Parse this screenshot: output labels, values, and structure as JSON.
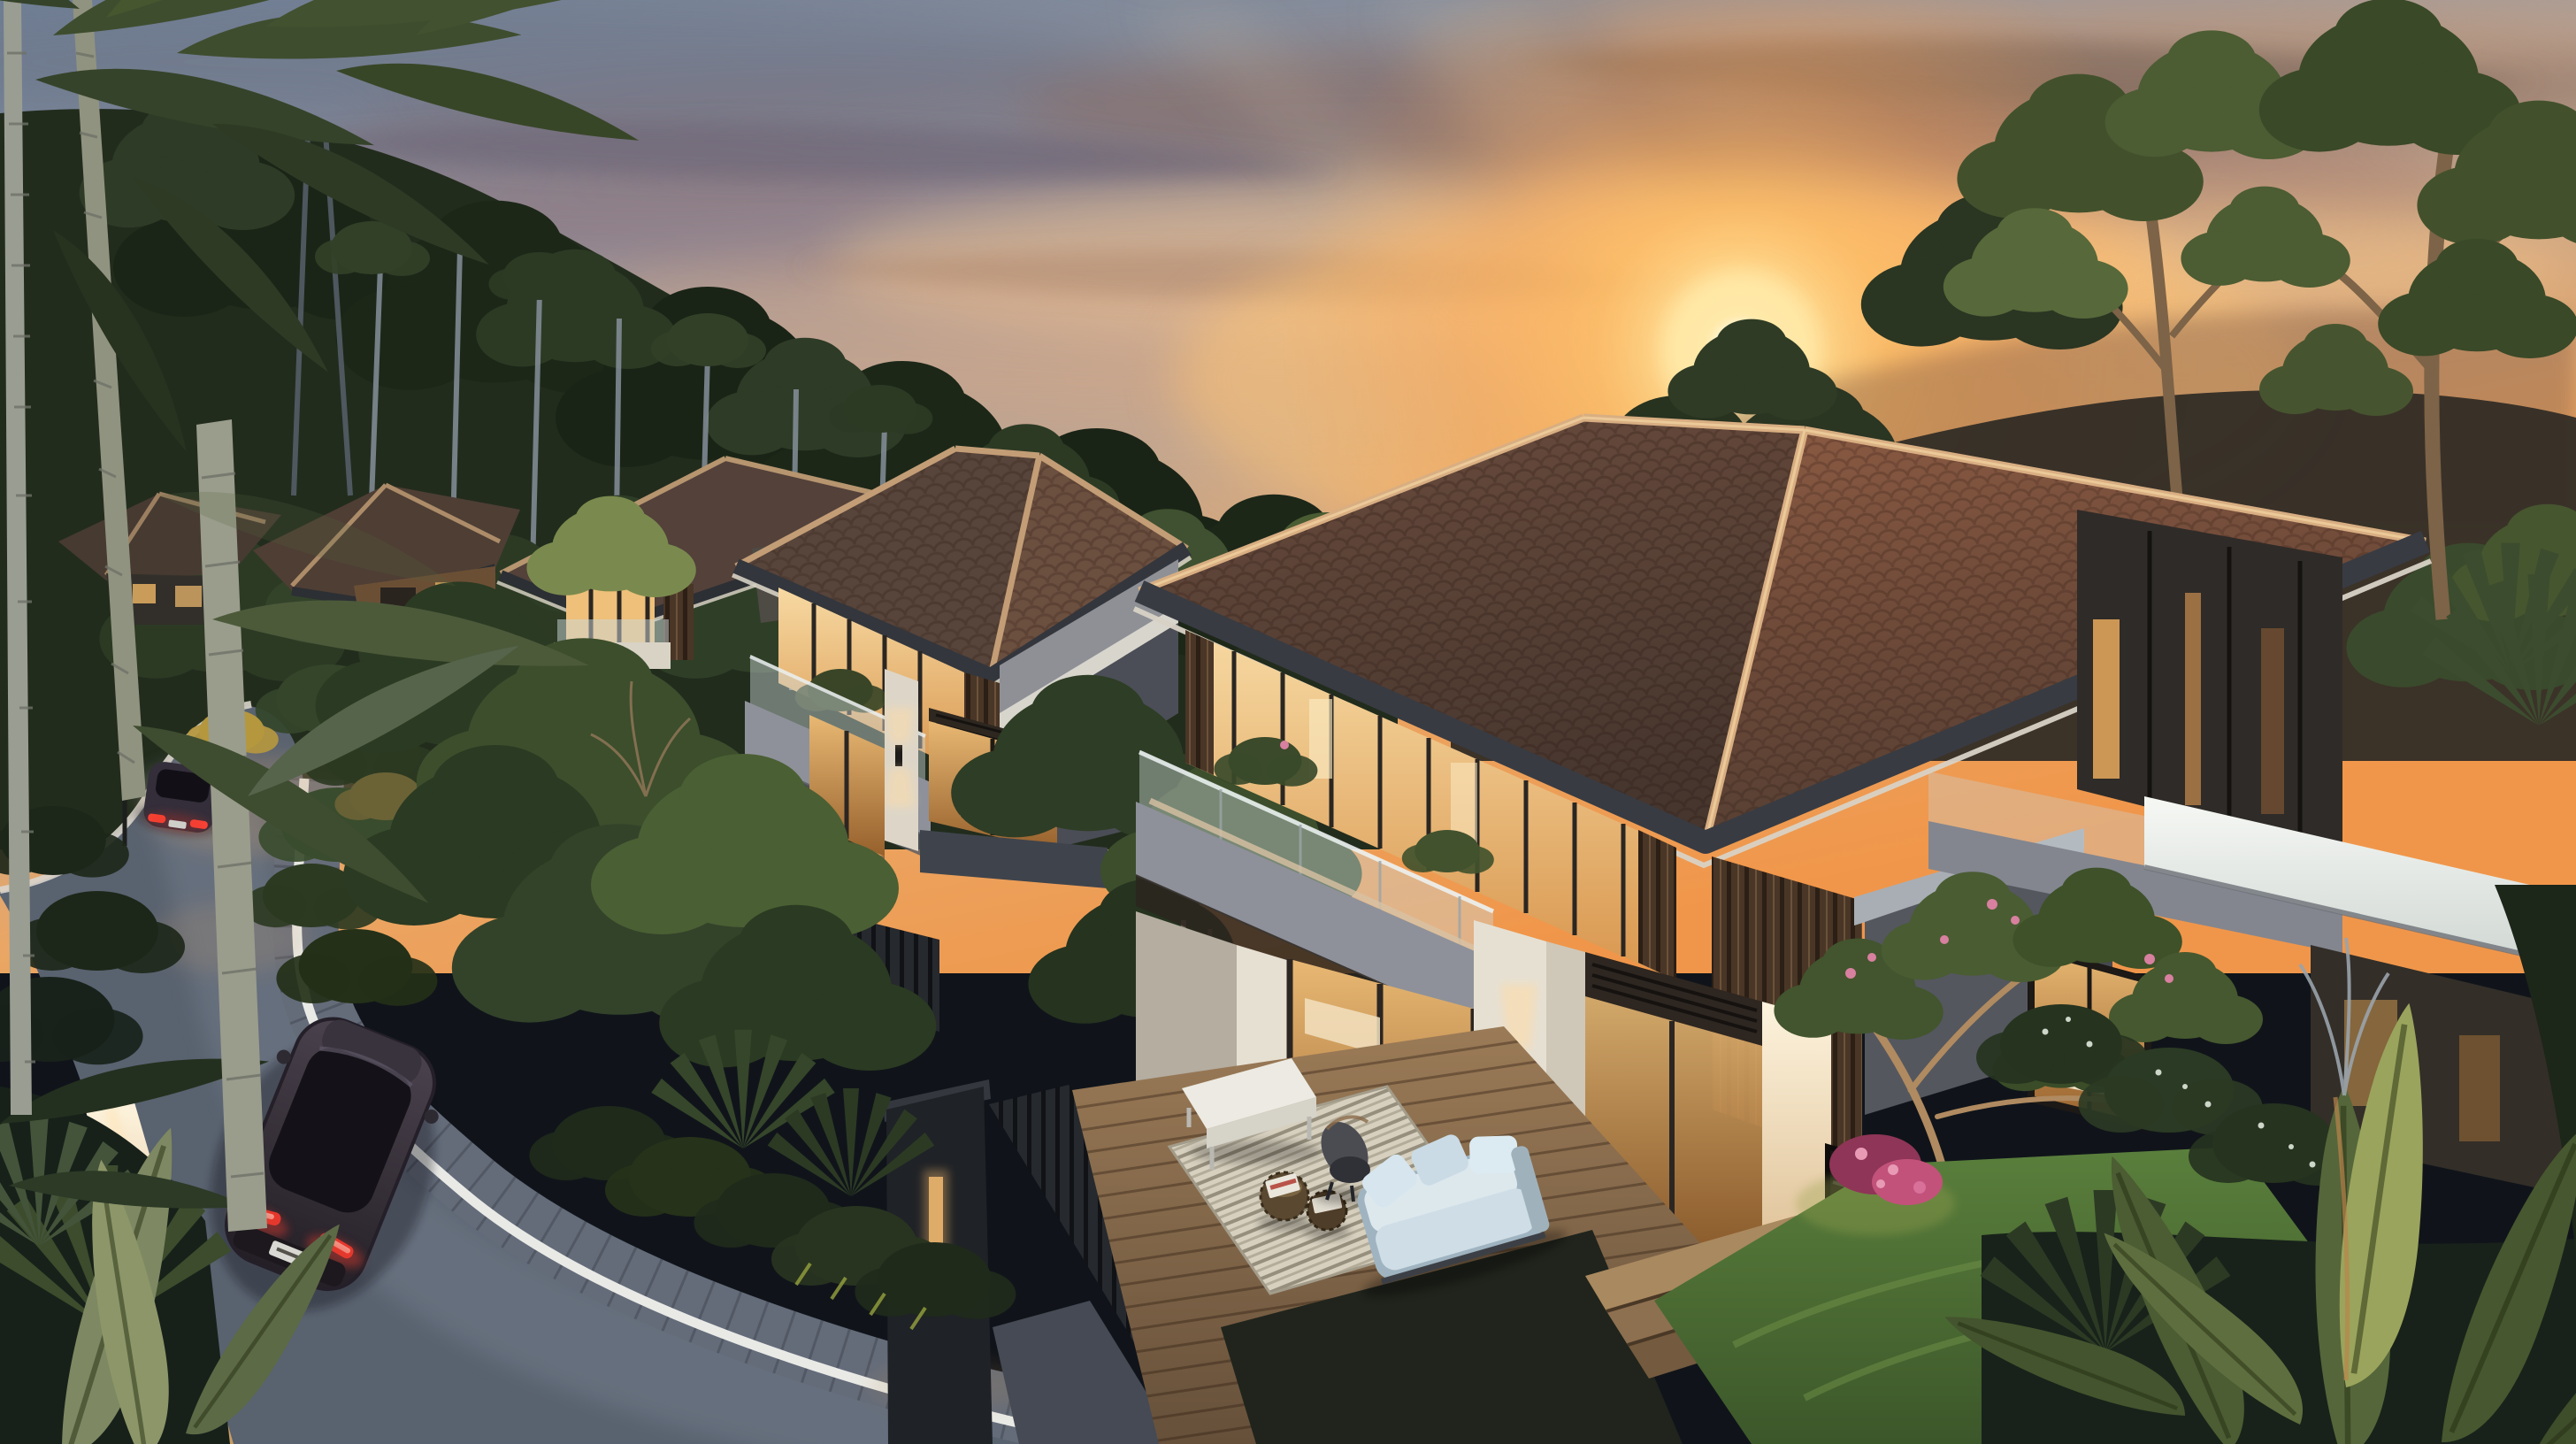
{
  "scene": {
    "description": "Dusk aerial rendering of a hillside estate: a receding row of modern two-storey villas with brown hip tile roofs and warm glowing interiors, a curving asphalt road with white curb and two dark cars with lit red taillights, a furnished timber terrace with a pale blue sofa, rattan poufs, striped rug and white bench, lush tropical gardens with palms and banana plants, tall forested hills and an orange sunset sky with streaked clouds and the sun setting behind a tree.",
    "time_of_day": "sunset",
    "environment": "forested hillside villa estate",
    "weather": "clear with streaked clouds"
  },
  "objects": {
    "buildings": [
      "farthest villa",
      "far villa",
      "middle villa",
      "second villa",
      "main villa"
    ],
    "vehicles": [
      "dark hatchback on road near foreground",
      "distant dark sedan up the road"
    ],
    "terrace_furniture": [
      "white upholstered bench",
      "striped outdoor rug",
      "rattan pouf with magazines",
      "small rattan pouf",
      "dark sculptural lounge chair",
      "pale blue cushioned sofa",
      "timber garden steps"
    ],
    "vegetation": [
      "leaning palm trunks",
      "palm fronds",
      "eucalyptus forest hillside",
      "umbrella canopy trees",
      "banana plants",
      "frangipani tree with pink flowers",
      "white flowering shrubs",
      "clipped hedges",
      "lawn"
    ],
    "lighting": [
      "setting sun",
      "warm interior lights",
      "wall sconce with up-down glow",
      "gate pier light",
      "lit curb retaining wall",
      "street lamp",
      "car taillights"
    ]
  },
  "palette": {
    "sky_top": "#6f7f96",
    "sky_warm": "#eaa664",
    "sun_core": "#fff6d8",
    "sun_glow": "#ffc060",
    "cloud_grey": "#7a707e",
    "cloud_warm": "#f6cf9c",
    "hill_forest": "#222c1d",
    "ridge_dusk": "#332e26",
    "forest_green": "#2e3d25",
    "leaf_highlight": "#8fa05a",
    "roof_shadow": "#53413a",
    "roof_lit": "#7c523c",
    "ridge_cap": "#d8ae82",
    "eave_fascia": "#383b42",
    "wall_white": "#e6e0d3",
    "wall_grey": "#54575e",
    "wood_slat": "#43342a",
    "window_warm": "#f2c17c",
    "window_deep": "#b9813f",
    "glass_cool": "#cdd8da",
    "balcony_grey": "#8e919a",
    "parapet_white": "#eef0ec",
    "road_asphalt": "#59626f",
    "road_sheen": "#76808e",
    "curb_white": "#e9eae6",
    "paver_grey": "#646c7a",
    "wall_lit_warm": "#f2dcba",
    "car_body": "#3b3440",
    "taillight_red": "#ff4434",
    "deck_wood": "#8a6c4e",
    "rug_cream": "#ded7c6",
    "sofa_blue": "#dde8ed",
    "bench_white": "#eceae2",
    "pouf_rattan": "#5a4830",
    "lawn_green": "#4c6e35",
    "banana_lit": "#9aa45c",
    "flower_pink": "#d8809f",
    "palm_trunk": "#9a9d92",
    "gate_light": "#d8a868"
  }
}
